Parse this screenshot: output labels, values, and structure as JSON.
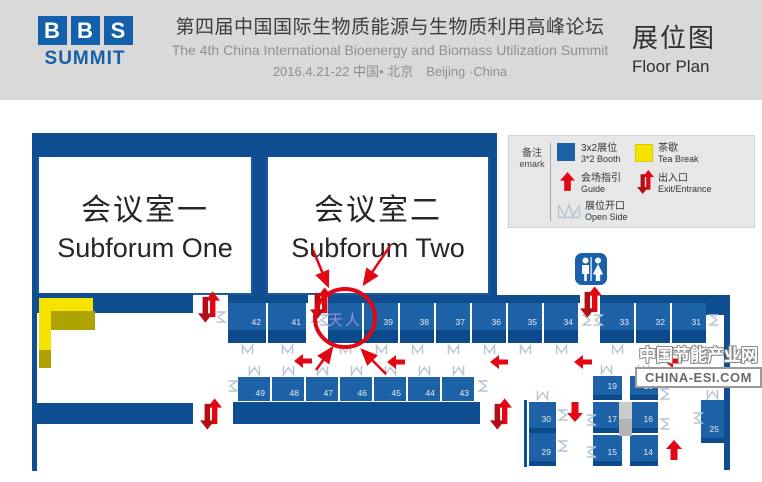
{
  "header": {
    "logo_letters": [
      "B",
      "B",
      "S"
    ],
    "logo_subtitle": "SUMMIT",
    "title_cn": "第四届中国国际生物质能源与生物质利用高峰论坛",
    "title_en": "The 4th China International Bioenergy and Biomass Utilization Summit",
    "date_location": "2016.4.21-22 中国• 北京　Beijing ·China",
    "floorplan_title_cn": "展位图",
    "floorplan_title_en": "Floor Plan"
  },
  "legend": {
    "note_cn": "备注",
    "note_en": "emark",
    "items": [
      {
        "id": "booth",
        "cn": "3x2展位",
        "en": "3*2 Booth"
      },
      {
        "id": "teabreak",
        "cn": "茶歇",
        "en": "Tea Break"
      },
      {
        "id": "guide",
        "cn": "会场指引",
        "en": "Guide"
      },
      {
        "id": "exit",
        "cn": "出入口",
        "en": "Exit/Entrance"
      },
      {
        "id": "openside",
        "cn": "展位开口",
        "en": "Open Side"
      }
    ]
  },
  "rooms": [
    {
      "cn": "会议室一",
      "en": "Subforum One"
    },
    {
      "cn": "会议室二",
      "en": "Subforum Two"
    }
  ],
  "floor": {
    "row1_left": [
      "42",
      "41"
    ],
    "row1_mid": [
      "天人",
      "39",
      "38",
      "37",
      "36",
      "35",
      "34"
    ],
    "row1_right": [
      "33",
      "32",
      "31"
    ],
    "row2": [
      "49",
      "48",
      "47",
      "46",
      "45",
      "44",
      "43"
    ],
    "col_a": [
      "30",
      "29"
    ],
    "col_b": [
      "19",
      "17",
      "15"
    ],
    "col_c": [
      "18",
      "16",
      "14"
    ],
    "col_d": [
      "25"
    ],
    "highlight_label": "天人"
  },
  "watermark": {
    "line1": "中国节能产业网",
    "line2": "CHINA-ESI.COM"
  },
  "colors": {
    "logo_blue": "#1560ab",
    "booth_blue": "#1d62a6",
    "wall_navy": "#0f4e91",
    "teabreak_yellow": "#f6e400",
    "teabreak_shadow": "#aea300",
    "arrow_red": "#e30613",
    "arrow_red_dark": "#b10e16",
    "highlight_text": "#9a8fd6",
    "marker_gray": "#b9c6d4"
  }
}
